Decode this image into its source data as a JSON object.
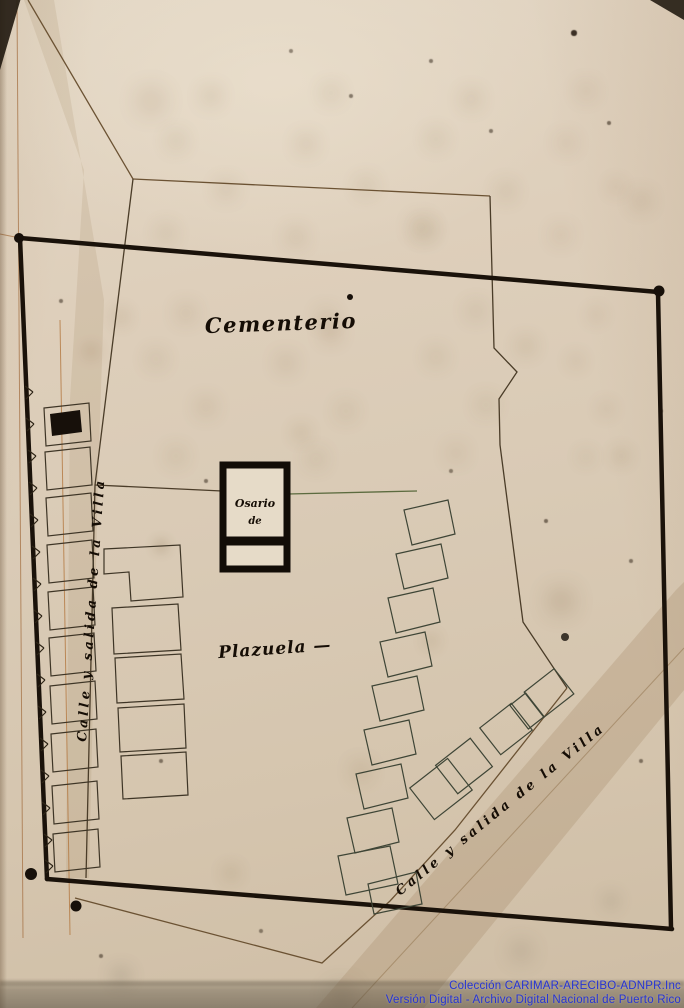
{
  "map": {
    "labels": {
      "cemetery": "Cementerio",
      "plaza": "Plazuela —",
      "chapel_line1": "Osario",
      "chapel_line2": "de",
      "street_left": "Calle y salida de la Villa",
      "street_right": "Calle y salida de la Villa"
    },
    "colors": {
      "paper": "#dbceb8",
      "heavy_ink": "#1a120a",
      "line_ink": "#4a3c29",
      "pencil_sepia": "#6b5233",
      "green_ink": "#5c6b3f",
      "margin_ruling": "#b3773f",
      "watermark_blue": "#2634d4"
    }
  },
  "watermark": {
    "line1": "Colección CARIMAR-ARECIBO-ADNPR.Inc",
    "line2": "Versión Digital - Archivo Digital Nacional de Puerto Rico"
  }
}
